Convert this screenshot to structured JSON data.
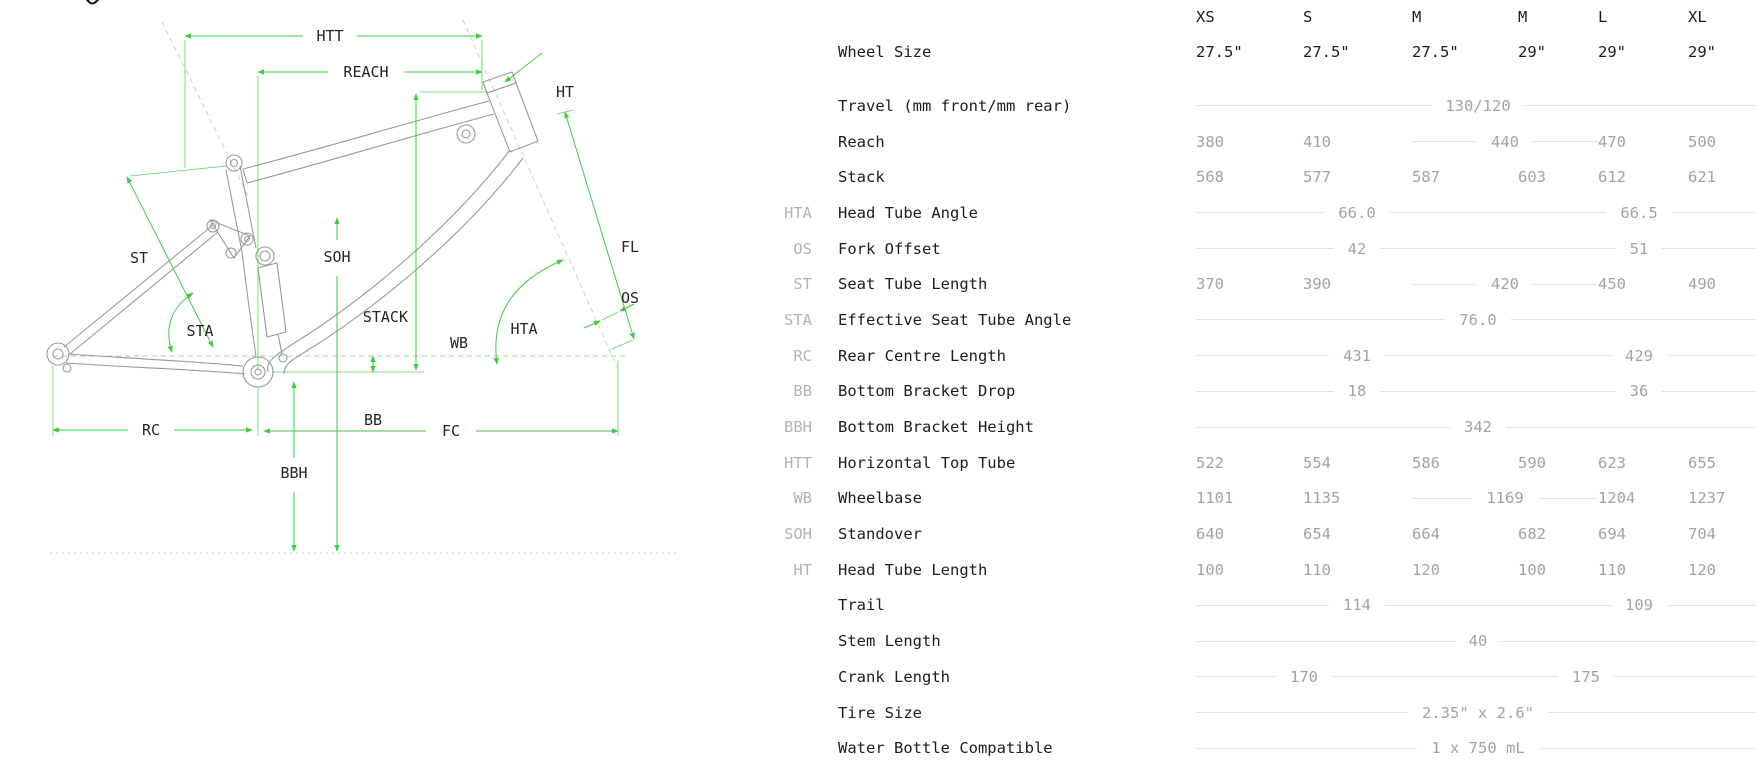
{
  "colors": {
    "dimension_green": "#3ecb41",
    "frame_gray": "#9a9a9a",
    "label_ink": "#1d1d1b",
    "abbr_gray": "#b6b3ad",
    "value_gray": "#a7a29a",
    "rule_gray": "#e5e2de"
  },
  "diagram": {
    "labels": {
      "htt": "HTT",
      "reach": "REACH",
      "ht": "HT",
      "st": "ST",
      "soh": "SOH",
      "stack": "STACK",
      "fl": "FL",
      "os": "OS",
      "sta": "STA",
      "hta": "HTA",
      "wb": "WB",
      "bb": "BB",
      "rc": "RC",
      "fc": "FC",
      "bbh": "BBH"
    }
  },
  "table": {
    "wheel_row_label": "Wheel Size",
    "columns": [
      {
        "size": "XS",
        "wheel": "27.5\""
      },
      {
        "size": "S",
        "wheel": "27.5\""
      },
      {
        "size": "M",
        "wheel": "27.5\""
      },
      {
        "size": "M",
        "wheel": "29\""
      },
      {
        "size": "L",
        "wheel": "29\""
      },
      {
        "size": "XL",
        "wheel": "29\""
      }
    ],
    "rows": [
      {
        "abbr": "",
        "label": "Travel (mm front/mm rear)",
        "cells": [
          {
            "span": 6,
            "value": "130/120",
            "lines": true
          }
        ]
      },
      {
        "abbr": "",
        "label": "Reach",
        "cells": [
          {
            "value": "380"
          },
          {
            "value": "410"
          },
          {
            "span": 2,
            "value": "440",
            "lines": true
          },
          {
            "value": "470"
          },
          {
            "value": "500"
          }
        ]
      },
      {
        "abbr": "",
        "label": "Stack",
        "cells": [
          {
            "value": "568"
          },
          {
            "value": "577"
          },
          {
            "value": "587"
          },
          {
            "value": "603"
          },
          {
            "value": "612"
          },
          {
            "value": "621"
          }
        ]
      },
      {
        "abbr": "HTA",
        "label": "Head Tube Angle",
        "cells": [
          {
            "span": 3,
            "value": "66.0",
            "lines": true
          },
          {
            "span": 3,
            "value": "66.5",
            "lines": true
          }
        ]
      },
      {
        "abbr": "OS",
        "label": "Fork Offset",
        "cells": [
          {
            "span": 3,
            "value": "42",
            "lines": true
          },
          {
            "span": 3,
            "value": "51",
            "lines": true
          }
        ]
      },
      {
        "abbr": "ST",
        "label": "Seat Tube Length",
        "cells": [
          {
            "value": "370"
          },
          {
            "value": "390"
          },
          {
            "span": 2,
            "value": "420",
            "lines": true
          },
          {
            "value": "450"
          },
          {
            "value": "490"
          }
        ]
      },
      {
        "abbr": "STA",
        "label": "Effective Seat Tube Angle",
        "cells": [
          {
            "span": 6,
            "value": "76.0",
            "lines": true
          }
        ]
      },
      {
        "abbr": "RC",
        "label": "Rear Centre Length",
        "cells": [
          {
            "span": 3,
            "value": "431",
            "lines": true
          },
          {
            "span": 3,
            "value": "429",
            "lines": true
          }
        ]
      },
      {
        "abbr": "BB",
        "label": "Bottom Bracket Drop",
        "cells": [
          {
            "span": 3,
            "value": "18",
            "lines": true
          },
          {
            "span": 3,
            "value": "36",
            "lines": true
          }
        ]
      },
      {
        "abbr": "BBH",
        "label": "Bottom Bracket Height",
        "cells": [
          {
            "span": 6,
            "value": "342",
            "lines": true
          }
        ]
      },
      {
        "abbr": "HTT",
        "label": "Horizontal Top Tube",
        "cells": [
          {
            "value": "522"
          },
          {
            "value": "554"
          },
          {
            "value": "586"
          },
          {
            "value": "590"
          },
          {
            "value": "623"
          },
          {
            "value": "655"
          }
        ]
      },
      {
        "abbr": "WB",
        "label": "Wheelbase",
        "cells": [
          {
            "value": "1101"
          },
          {
            "value": "1135"
          },
          {
            "span": 2,
            "value": "1169",
            "lines": true
          },
          {
            "value": "1204"
          },
          {
            "value": "1237"
          }
        ]
      },
      {
        "abbr": "SOH",
        "label": "Standover",
        "cells": [
          {
            "value": "640"
          },
          {
            "value": "654"
          },
          {
            "value": "664"
          },
          {
            "value": "682"
          },
          {
            "value": "694"
          },
          {
            "value": "704"
          }
        ]
      },
      {
        "abbr": "HT",
        "label": "Head Tube Length",
        "cells": [
          {
            "value": "100"
          },
          {
            "value": "110"
          },
          {
            "value": "120"
          },
          {
            "value": "100"
          },
          {
            "value": "110"
          },
          {
            "value": "120"
          }
        ]
      },
      {
        "abbr": "",
        "label": "Trail",
        "cells": [
          {
            "span": 3,
            "value": "114",
            "lines": true
          },
          {
            "span": 3,
            "value": "109",
            "lines": true
          }
        ]
      },
      {
        "abbr": "",
        "label": "Stem Length",
        "cells": [
          {
            "span": 6,
            "value": "40",
            "lines": true
          }
        ]
      },
      {
        "abbr": "",
        "label": "Crank Length",
        "cells": [
          {
            "span": 2,
            "value": "170",
            "lines": true
          },
          {
            "span": 4,
            "value": "175",
            "lines": true
          }
        ]
      },
      {
        "abbr": "",
        "label": "Tire Size",
        "cells": [
          {
            "span": 6,
            "value": "2.35\" x 2.6\"",
            "lines": true
          }
        ]
      },
      {
        "abbr": "",
        "label": "Water Bottle Compatible",
        "cells": [
          {
            "span": 6,
            "value": "1 x 750 mL",
            "lines": true
          }
        ]
      }
    ]
  }
}
